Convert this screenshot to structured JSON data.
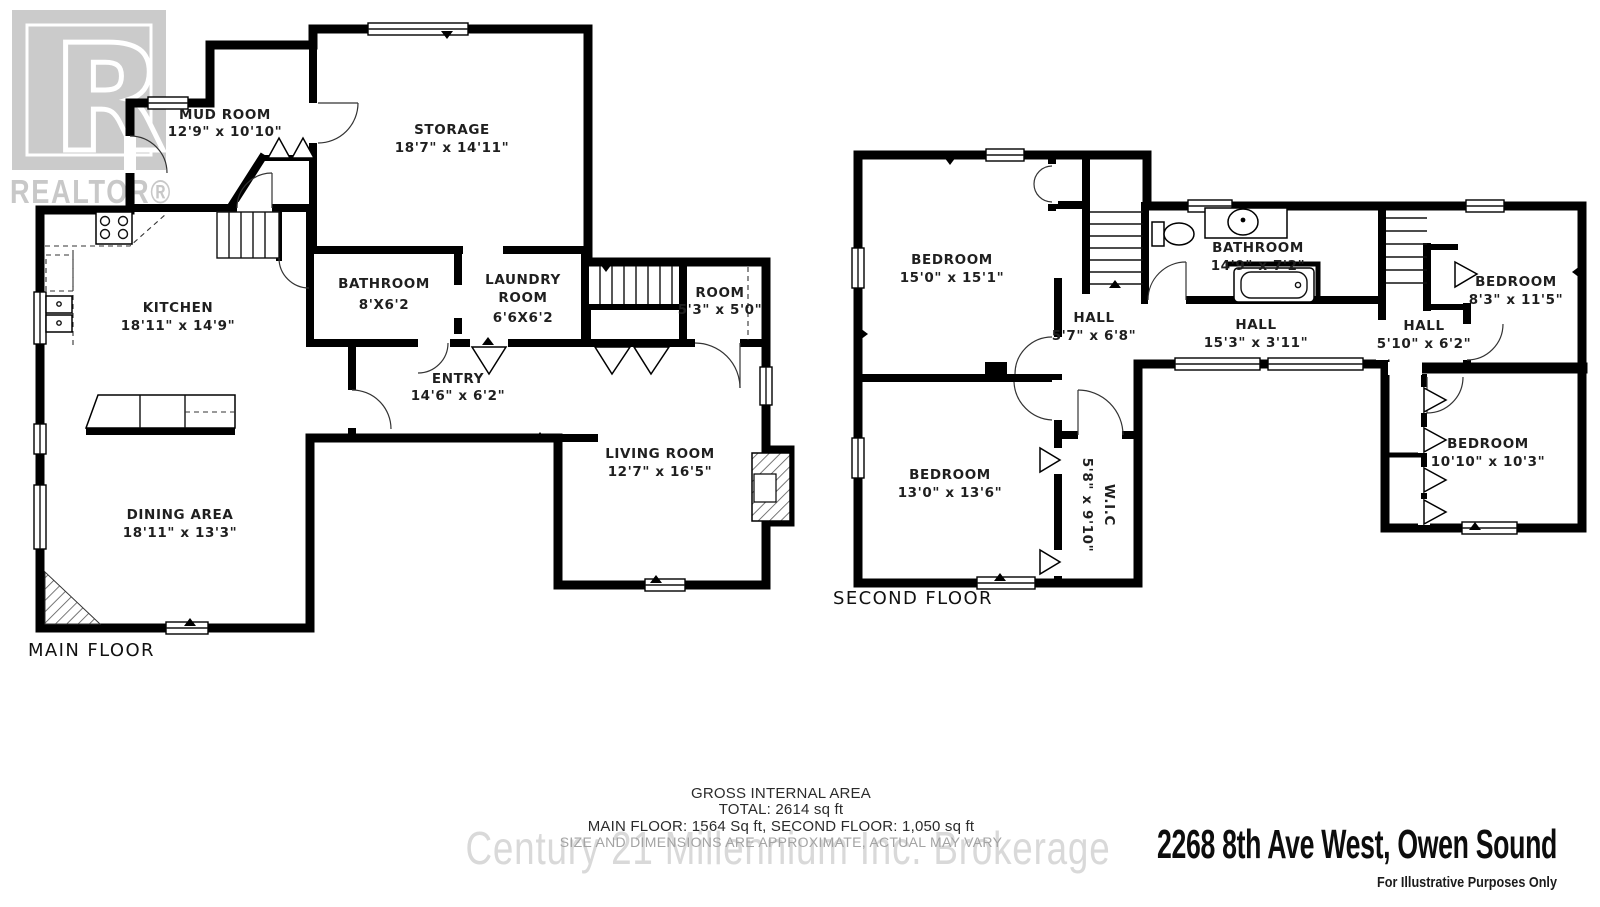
{
  "watermarks": {
    "realtor_letter": "R",
    "realtor_text": "REALTOR®",
    "brokerage": "Century 21 Millennium Inc. Brokerage"
  },
  "main_floor": {
    "label": "MAIN FLOOR",
    "rooms": [
      {
        "line1": "MUD ROOM",
        "dims": "12'9\" x 10'10\""
      },
      {
        "line1": "STORAGE",
        "dims": "18'7\" x 14'11\""
      },
      {
        "line1": "BATHROOM",
        "dims": "8'X6'2"
      },
      {
        "line1": "LAUNDRY",
        "line2": "ROOM",
        "dims": "6'6X6'2"
      },
      {
        "line1": "ROOM",
        "dims": "5'3\" x 5'0\""
      },
      {
        "line1": "KITCHEN",
        "dims": "18'11\" x 14'9\""
      },
      {
        "line1": "ENTRY",
        "dims": "14'6\" x 6'2\""
      },
      {
        "line1": "LIVING ROOM",
        "dims": "12'7\" x 16'5\""
      },
      {
        "line1": "DINING AREA",
        "dims": "18'11\" x 13'3\""
      }
    ]
  },
  "second_floor": {
    "label": "SECOND FLOOR",
    "rooms": [
      {
        "line1": "BEDROOM",
        "dims": "15'0\" x 15'1\""
      },
      {
        "line1": "HALL",
        "dims": "5'7\" x 6'8\""
      },
      {
        "line1": "BATHROOM",
        "dims": "14'9\" x 7'2\""
      },
      {
        "line1": "HALL",
        "dims": "15'3\" x 3'11\""
      },
      {
        "line1": "HALL",
        "dims": "5'10\" x 6'2\""
      },
      {
        "line1": "BEDROOM",
        "dims": "8'3\" x 11'5\""
      },
      {
        "line1": "BEDROOM",
        "dims": "10'10\" x 10'3\""
      },
      {
        "line1": "BEDROOM",
        "dims": "13'0\" x 13'6\""
      },
      {
        "line1": "W.I.C",
        "dims": "5'8\" x 9'10\""
      }
    ]
  },
  "footer": {
    "area_title": "GROSS INTERNAL AREA",
    "total": "TOTAL: 2614 sq ft",
    "floors": "MAIN FLOOR: 1564 Sq ft, SECOND FLOOR: 1,050 sq ft",
    "disclaimer": "SIZE AND DIMENSIONS ARE APPROXIMATE, ACTUAL MAY VARY",
    "address": "2268 8th Ave West, Owen Sound",
    "illustrative": "For Illustrative Purposes Only"
  },
  "colors": {
    "walls": "#000000",
    "watermark_gray": "#c9c9c9",
    "brokerage_gray": "#d9d9d9",
    "disclaimer_gray": "#a3a3a3"
  }
}
